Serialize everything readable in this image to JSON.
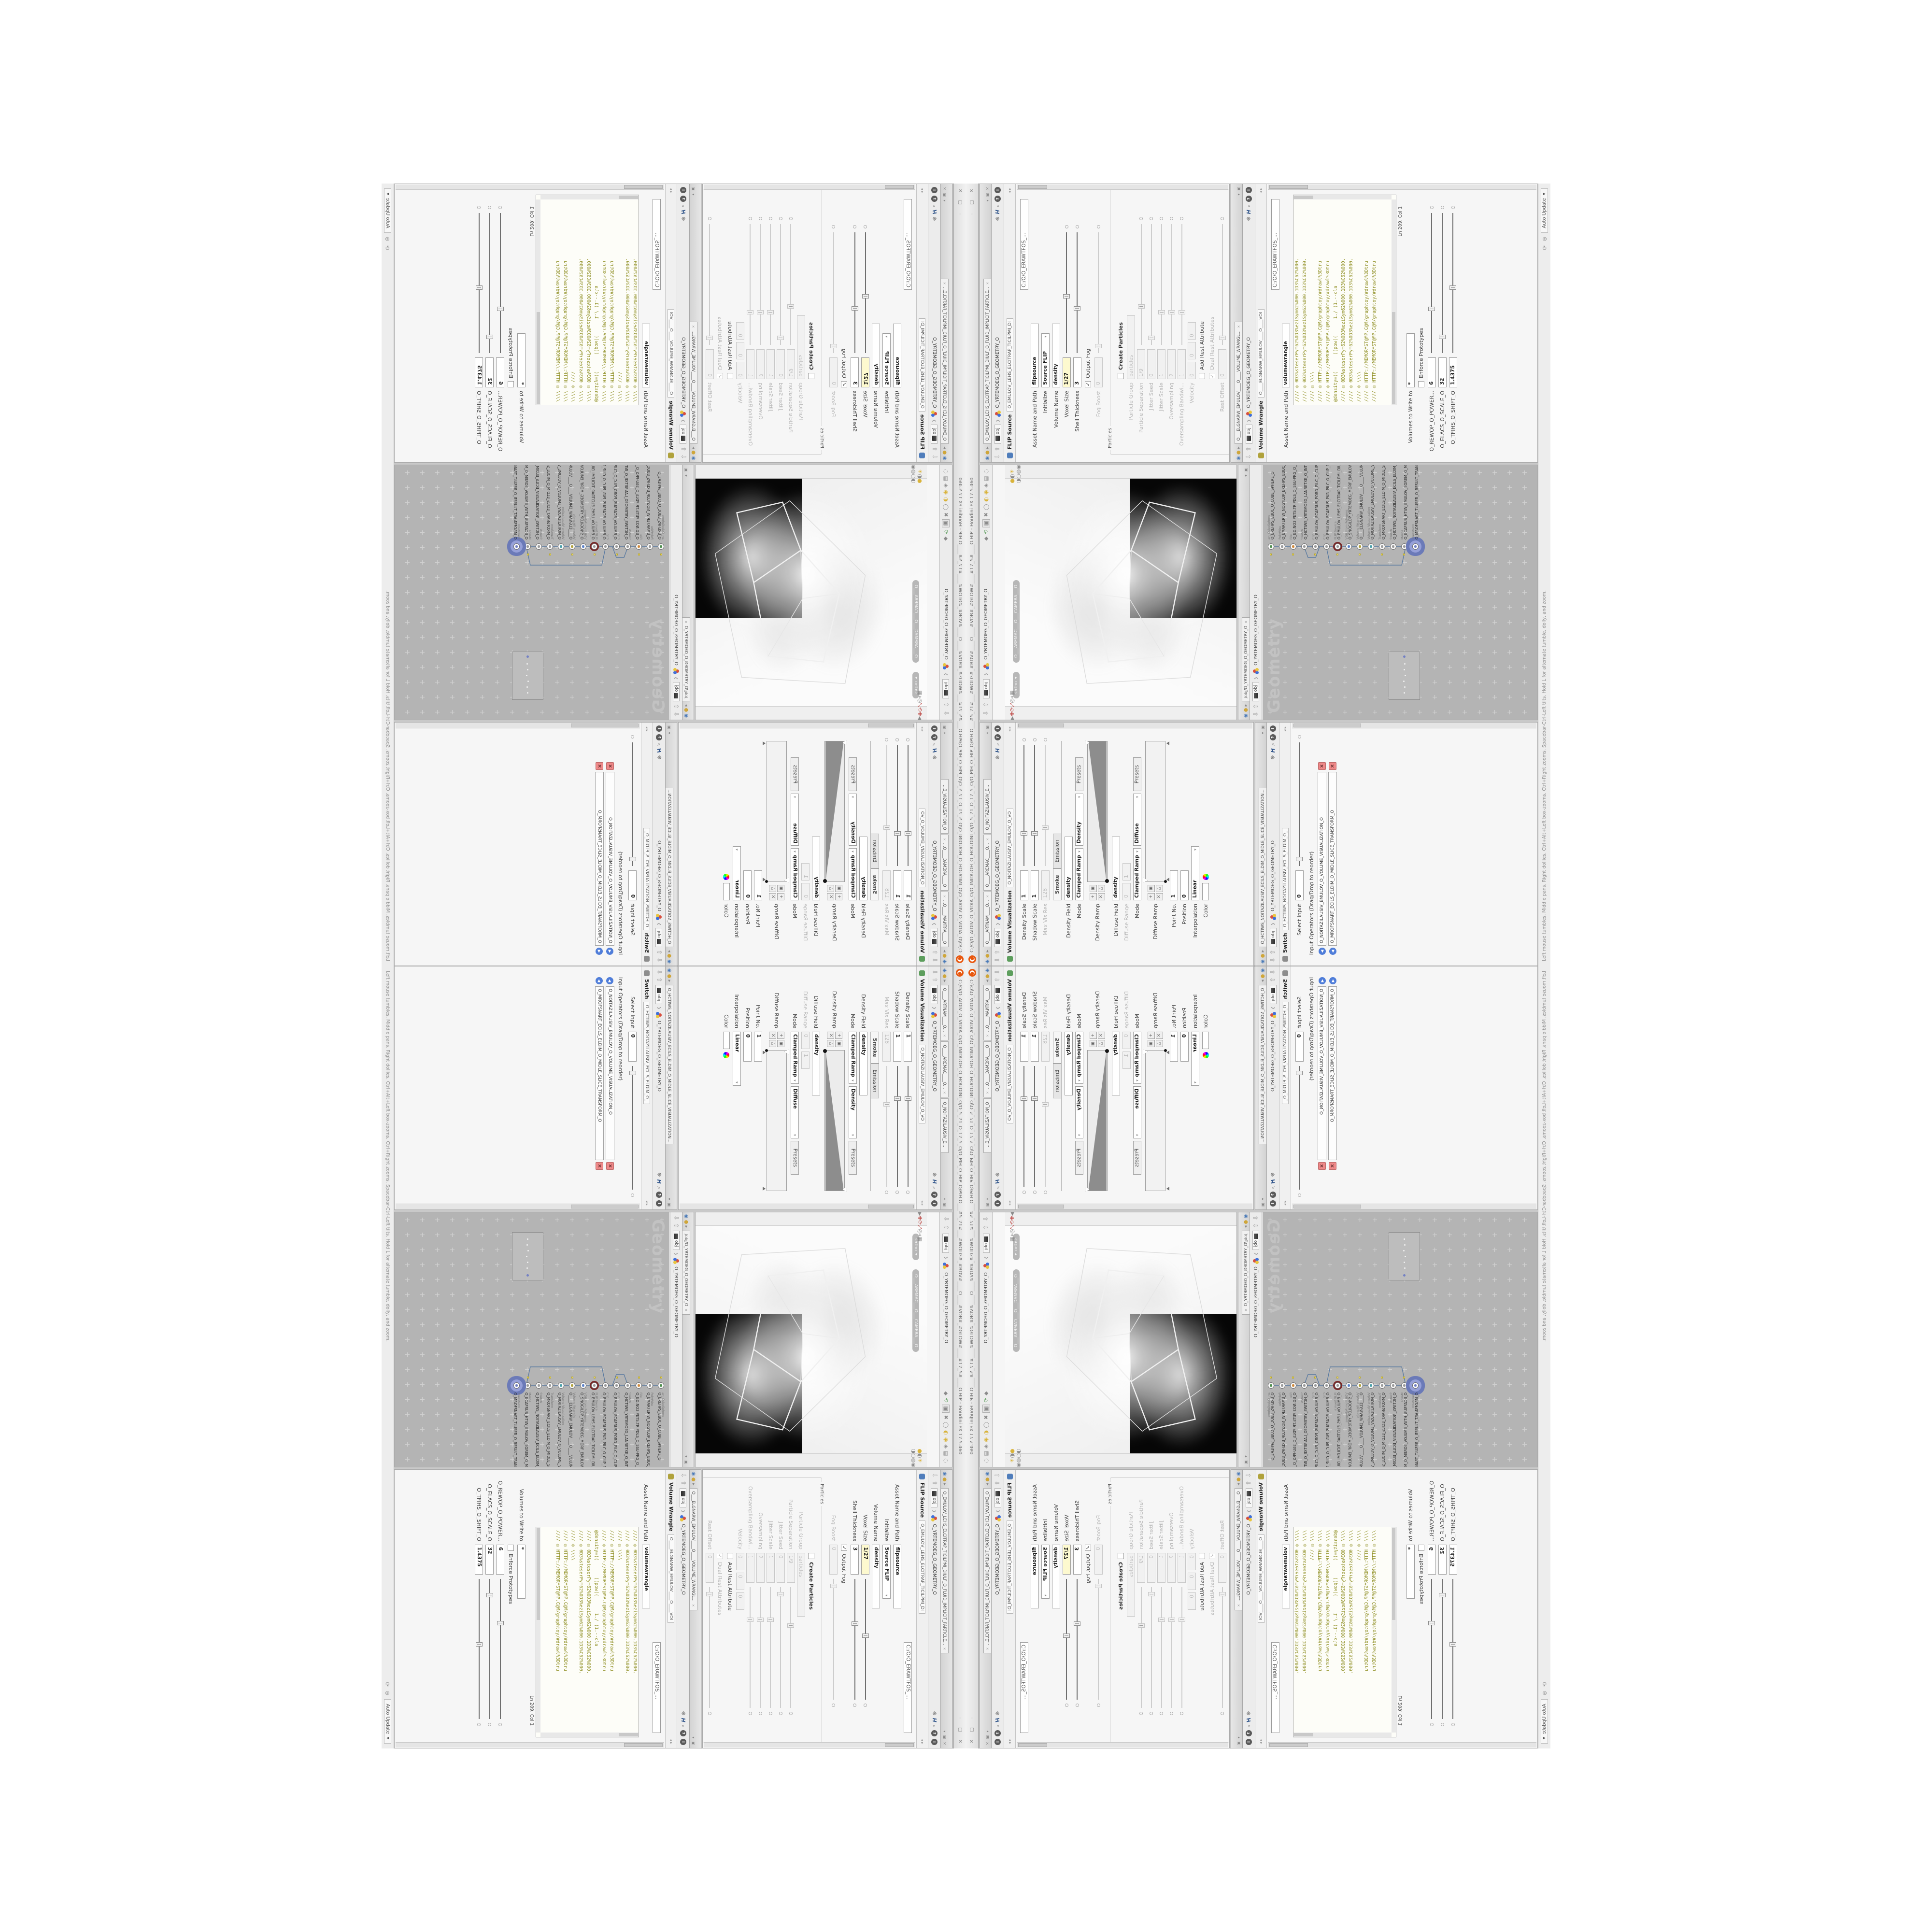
{
  "window": {
    "title": "C:/O/O_AIDIV_O_VIDIA_O/O_INIDUOH_O_HOUDINI_O/O_5_71_O_17_5_O/O_PIH_O_HIP_O/PIH.O___#5_71#___#WOLG#_#BDV#____O____#VDB#_#GLOW#____#17_5#____O.HIP - Houdini FX 17.5.460",
    "btn_min": "–",
    "btn_max": "▢",
    "btn_close": "✕",
    "status_left": "Left mouse tumbles. Middle pans. Right dollies. Ctrl+Alt+Left box-zooms. Ctrl+Right zooms. Spacebar-Ctrl-Left tilts. Hold L for alternate tumble, dolly, and zoom.",
    "update_mode": "Auto Update"
  },
  "breadcrumb": {
    "root": "obj",
    "node": "O_YRTEMOEG_O_GEOMETRY_O"
  },
  "icons": {
    "caret": "▾",
    "back": "⇩",
    "fwd": "⇧",
    "gear": "❋",
    "help_h": "H",
    "mag": "⌕",
    "q": "?",
    "i": "i",
    "tab_menu": "◉",
    "tab_pin": "●",
    "tab_play": "▸",
    "close": "✕",
    "win_shade": "▾",
    "win_float": "▣",
    "ramp_add": "+",
    "ramp_del": "✕",
    "ramp_opt": "▣",
    "ramp_tri": "△",
    "status_sync": "⟳",
    "status_hand": "⊛",
    "minimize_arrows": "◂ ▸"
  },
  "viz_pane": {
    "tabs": [
      {
        "label": "O____ARTNAM____O...",
        "x": "✕"
      },
      {
        "label": "O____AREMAC____O...",
        "x": "✕"
      },
      {
        "label": "O_NOITAZILAUSIV_E...",
        "x": ""
      }
    ],
    "node_type": "Volume Visualization",
    "node_tab": "O_NOITAZILAUSIV_EMULOV_O_VO",
    "rows1": [
      {
        "label": "Density Scale",
        "value": "1",
        "cls": "sm slider t25"
      },
      {
        "label": "Shadow Scale",
        "value": "1",
        "cls": "sm slider t25"
      },
      {
        "label": "Max Vis Res",
        "value": "128",
        "cls": "sm dis slider t30"
      }
    ],
    "tab_smoke": "Smoke",
    "tab_emission": "Emission",
    "rows2": [
      {
        "label": "Density Field",
        "value": "density",
        "cls": "lg"
      },
      {
        "label": "Mode",
        "value": "Clamped Ramp",
        "value2": "Density",
        "value3": "Presets",
        "cls": "combo3 three"
      }
    ],
    "ramp1_label": "Density Ramp",
    "rows3": [
      {
        "label": "Diffuse Field",
        "value": "density",
        "cls": "lg"
      },
      {
        "label": "Diffuse Range",
        "value": "0",
        "value2": "1",
        "cls": "xs dis two"
      },
      {
        "label": "Mode",
        "value": "Clamped Ramp",
        "value2": "Diffuse",
        "value3": "Presets",
        "cls": "combo3 three"
      }
    ],
    "ramp2_label": "Diffuse Ramp",
    "rows4": [
      {
        "label": "Point No.",
        "value": "1",
        "cls": "sm"
      },
      {
        "label": "Position",
        "value": "0",
        "cls": "sm"
      },
      {
        "label": "Interpolation",
        "value": "Linear",
        "cls": "md combo"
      }
    ],
    "color_label": "Color"
  },
  "switch_pane": {
    "tab": "O_HCTIWS_NOITAZILAUSIV_ECILS_ELDIM_O_MIDLE_SLICE_VISUALIZATION...",
    "node_type": "Switch",
    "node_tab": "O_HCTIWS_NOITAZILAUSIV_ECILS_ELDIM_O_",
    "rows": [
      {
        "label": "Select Input",
        "value": "0",
        "cls": "sm slider t5"
      }
    ],
    "list_label": "Input Operators (Drag/Drop to reorder)",
    "inputs": [
      {
        "name": "O_NOITAZILAUSIV_EMULOV_O_VOLUME_VISUALIZATION_O",
        "del": "✕",
        "arr": "◀"
      },
      {
        "name": "O_MROFSNART_ECILS_ELDIM_O_MIDLE_SLICE_TRANSFORM_O",
        "del": "✕",
        "arr": "◀"
      }
    ]
  },
  "flip_pane": {
    "tab": "O_EMULOV_LEHS_ELCITRAP_TICILPMI_DIULF_O_FLUID_IMPLICIT_PARTICLE...",
    "node_type": "FLIP Source",
    "node_tab": "O_EMULOV_LEHS_ELCITRAP_TICILPMI_DI",
    "rows_top": [
      {
        "value": "C:/O/O_ERAWTFOS_...",
        "cls": "pathrow"
      },
      {
        "label": "Asset Name and Path",
        "value": "flipsource",
        "cls": "lg"
      },
      {
        "label": "Initialize",
        "value": "Source FLIP",
        "cls": "md combo"
      },
      {
        "label": "Volume Name",
        "value": "density",
        "cls": "lg"
      },
      {
        "label": "Voxel Size",
        "value": "1/27",
        "cls": "sm yellow slider t45"
      },
      {
        "label": "Shell Thickness",
        "value": "3",
        "cls": "sm slider t35"
      },
      {
        "label": "Output Fog",
        "check": "✓",
        "cls": "chk"
      },
      {
        "label": "Fog Boost",
        "value": "0",
        "cls": "sm dis slider t5"
      }
    ],
    "group_label": "Particles",
    "rows_particles": [
      {
        "label": "Create Particles",
        "check": "",
        "cls": "chk boldlabel"
      },
      {
        "label": "Particle Group",
        "value": "particles",
        "cls": "lg dis"
      },
      {
        "label": "Particle Separation",
        "value": "1/9",
        "cls": "sm dis slider t30"
      },
      {
        "label": "Jitter Seed",
        "value": "0",
        "cls": "sm dis slider t5"
      },
      {
        "label": "Jitter Scale",
        "value": "1",
        "cls": "sm dis slider t25"
      },
      {
        "label": "Oversampling",
        "value": "2",
        "cls": "sm dis slider t25"
      },
      {
        "label": "Oversampling Bandwi...",
        "value": "1",
        "cls": "sm dis slider t25"
      },
      {
        "label": "Velocity",
        "value": "0",
        "value2": "0",
        "value3": "0",
        "cls": "xs dis three"
      },
      {
        "label": "Add Rest Attribute",
        "check": "",
        "cls": "chk"
      },
      {
        "label": "Dual Rest Attributes",
        "check": "✓",
        "cls": "chk dis"
      },
      {
        "label": "Rest Offset",
        "value": "0",
        "cls": "sm dis slider t5"
      }
    ]
  },
  "wrangle_pane": {
    "tab": "O___ELGNARW_EMULOV____O____VOLUME_WRANGL...",
    "node_type": "Volume Wrangle",
    "node_tab": "O____ELGNARW_EMULOV____O____VOI",
    "rows_top": [
      {
        "value": "C:/O/O_ERAWTFOS_...",
        "cls": "pathrow"
      },
      {
        "label": "Asset Name and Path",
        "value": "volumewrangle",
        "cls": "lg"
      }
    ],
    "code_lines": [
      {
        "t": "//// ◎ 0D3%steserPym62%0D3%eziSym62%000.1D3%C62%000.",
        "c": ""
      },
      {
        "t": "//// ◎ 0D3%steserPym62%0D3%eziSym62%000.1D3%C62%000.",
        "c": ""
      },
      {
        "t": "//// ◎ \\\\\\\\",
        "c": ""
      },
      {
        "t": "//// ◎ HTTP://MEMORYST@MP.C@M/graphtoy/#drawl%3Dtru",
        "c": ""
      },
      {
        "t": "//// ◎ HTTP://MEMORYST@MP.C@M/graphtoy/#drawl%3Dtru",
        "c": ""
      },
      {
        "t": "",
        "c": ""
      },
      {
        "t": "@density=((      ((pow((      1./ (1.--cla",
        "c": "kw"
      },
      {
        "t": "",
        "c": ""
      },
      {
        "t": "//// ◎ 0D3%steserPym62%0D3%eziSym62%000.1D3%C62%000.",
        "c": ""
      },
      {
        "t": "//// ◎ 0D3%steserPym62%0D3%eziSym62%000.1D3%C62%000.",
        "c": ""
      },
      {
        "t": "//// ◎ \\\\\\\\",
        "c": ""
      },
      {
        "t": "//// ◎ HTTP://MEMORYST@MP.C@M/graphtoy/#drawl%3Dtru",
        "c": ""
      },
      {
        "t": "//// ◎ HTTP://MEMORYST@MP.C@M/graphtoy/#drawl%3Dtru",
        "c": ""
      }
    ],
    "ln_col": "Ln 209, Col 1",
    "rows_bottom": [
      {
        "label": "Volumes to Write to",
        "value": "*",
        "cls": "md"
      },
      {
        "label": "Enforce Prototypes",
        "check": "",
        "cls": "chk"
      },
      {
        "label": "O_REWOP_O_POWER...",
        "value": "6",
        "cls": "sm slider t30"
      },
      {
        "label": "O_ELACS_O_SCALE_O",
        "value": "32",
        "cls": "sm slider t10"
      },
      {
        "label": "O_TFIHS_O_SHIFT_O",
        "value": "1.4375",
        "cls": "sm slider t45"
      }
    ]
  },
  "viewport": {
    "ortho": "Ortho",
    "camera": "O___AREMAC___O___CAMERA___O",
    "top_icons": [
      {
        "g": "◆",
        "cls": ""
      },
      {
        "g": "⟲",
        "cls": "grn"
      },
      {
        "g": "▣",
        "cls": "boxed"
      },
      {
        "g": "✖",
        "cls": ""
      },
      {
        "g": "◯",
        "cls": ""
      },
      {
        "g": "◐",
        "cls": "yel"
      },
      {
        "g": "◉",
        "cls": "yel"
      },
      {
        "g": "◈",
        "cls": ""
      },
      {
        "g": "▤",
        "cls": ""
      },
      {
        "g": "◌",
        "cls": ""
      }
    ],
    "left_icons": [
      {
        "g": "◐",
        "cls": "yel boxed"
      },
      {
        "g": "◈",
        "cls": "yel"
      },
      {
        "g": "◆",
        "cls": "yel"
      },
      {
        "g": "▶",
        "cls": ""
      },
      {
        "g": "✚",
        "cls": "red"
      },
      {
        "g": "⟳",
        "cls": "red"
      },
      {
        "g": "⤢",
        "cls": "red"
      },
      {
        "g": "◎",
        "cls": ""
      },
      {
        "g": "⌖",
        "cls": ""
      },
      {
        "g": "▦",
        "cls": ""
      }
    ],
    "right_icons": [
      {
        "g": "●",
        "cls": "yel"
      },
      {
        "g": "◐",
        "cls": ""
      },
      {
        "g": "☀",
        "cls": "yel"
      },
      {
        "g": "◑",
        "cls": ""
      },
      {
        "g": "○",
        "cls": ""
      },
      {
        "g": "◍",
        "cls": ""
      },
      {
        "g": "◉",
        "cls": ""
      },
      {
        "g": "◌",
        "cls": ""
      }
    ]
  },
  "network": {
    "tab": "/obj/O_YRTEMOEG_O_GEOMETRY_O",
    "watermark": "Geometry",
    "nodes": [
      {
        "type": "an_CubeSphere",
        "name": "O_EREHPS_EBUC_O_CUBE_SPHERE_O",
        "cls": "n-green nflag"
      },
      {
        "type": "PolyWire",
        "name": "O_EMARFERIW_NOGYLOP_EREHPS_EBUC_O_CUBE_SPHERE_POLYGON_WIREFRAME_O",
        "cls": "n-gray"
      },
      {
        "type": "File",
        "name": "O_BD.NO3.PETS.TRIPDLS_O_5SU-PRG_O_GEOM5S_O.SLDPRT.STEP.3DM.OBJ",
        "cls": "n-orange nflag"
      },
      {
        "type": "Switch",
        "name": "O_HCTIWS_YRTEMOEG_LANRETXE_O_INTERNAL_EXTERNAL_GEOMETRY_S...",
        "cls": "n-gray"
      },
      {
        "type": "Clip",
        "name": "O_EMULOV_ECAFRUS_PORD_PILC_O_CLIP_DROP_SURFACE_VOLUME_O",
        "cls": "n-gray nflag"
      },
      {
        "type": "Clip",
        "name": "O_EMULOV_ECAFRUS_PKR_PILC_O_CLIP_PKR_SURFACE_VOLUME_O",
        "cls": "n-gray"
      },
      {
        "type": "FLIP Source",
        "name": "O_EMULOV_LEHS_ELCITRAP_TICILPMI_DIULF_O_FLUID_IMPLICIT_PARTICLE_SH...",
        "cls": "n-ringred nflag"
      },
      {
        "type": "VDB from Polygons",
        "name": "O_SNOGILOP_YRTEMOEG_MORF_EMULOV_BDV_O_VDB_VOLUME_FROM_GEOME...",
        "cls": "n-blue"
      },
      {
        "type": "Volume Wrangle",
        "name": "O____ELGNARW_EMULOV____O____VOLUME_WRANGLE____O",
        "cls": "n-olive nflag"
      },
      {
        "type": "Volume Visualization",
        "name": "O_NOITAZILAUSIV_EMULOV_O_VOLUME_VISUALIZATION_O",
        "cls": "n-teal"
      },
      {
        "type": "Transform",
        "name": "O_MROFSNART_ECILS_ELDIM_O_MIDLE_SLICE_TRANSFORM_O",
        "cls": "n-gray nflag"
      },
      {
        "type": "Switch",
        "name": "O_HCTIWS_NOITAZILAUSIV_ECILS_ELDIM_O_MIDLE_SLICE_VISUALIZATION_SW...",
        "cls": "n-gray"
      },
      {
        "type": "Merge",
        "name": "O_ECAFRUS_HTIW_EMULOV_EGREM_O_MERGE_VOLUME_WITH_SURFACE_O",
        "cls": "n-gray nflag"
      },
      {
        "type": "Transform",
        "name": "O_MROFSNART_TLUSER_O_RESULT_TRANSFORM_O",
        "cls": "n-purple sel"
      }
    ]
  },
  "colors": {
    "houdini_orange": "#e8570e",
    "keyed_field": "#fdf9cf",
    "node_select": "#6b7ab8",
    "wire": "#5a7aa0",
    "network_bg": "#b4b4b4",
    "code_olive": "#8f8f23"
  }
}
